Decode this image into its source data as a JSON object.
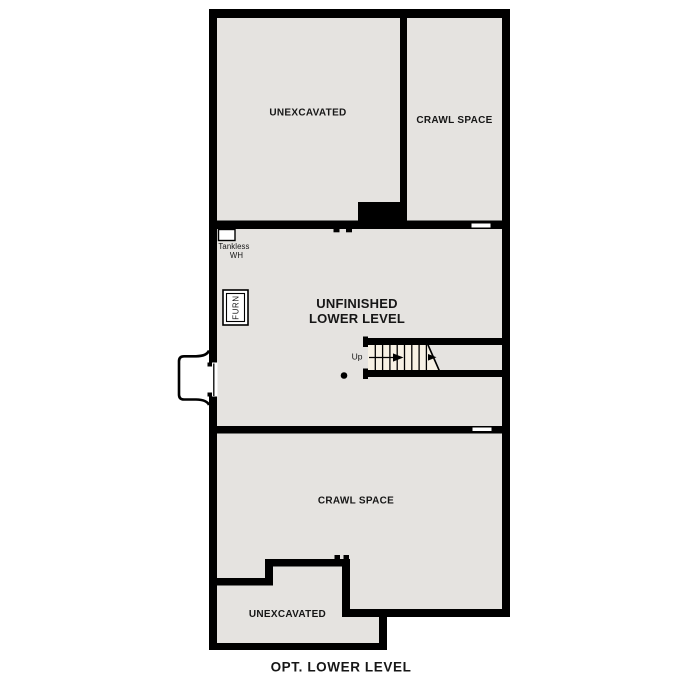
{
  "plan": {
    "title": "OPT. LOWER LEVEL"
  },
  "rooms": {
    "unexcavated_top": {
      "label": "UNEXCAVATED"
    },
    "crawl_space_top": {
      "label": "CRAWL SPACE"
    },
    "unfinished_lower_level": {
      "label_line1": "UNFINISHED",
      "label_line2": "LOWER LEVEL"
    },
    "crawl_space_bottom": {
      "label": "CRAWL SPACE"
    },
    "unexcavated_bottom": {
      "label": "UNEXCAVATED"
    }
  },
  "fixtures": {
    "tankless_water_heater": {
      "label_line1": "Tankless",
      "label_line2": "WH"
    },
    "furnace": {
      "label": "FURN"
    },
    "stairs": {
      "direction_label": "Up"
    },
    "support_post": {
      "shape": "filled-dot"
    },
    "window_well": {
      "shape": "rounded-bump-out"
    }
  },
  "colors": {
    "background": "#ffffff",
    "wall": "#000000",
    "room_fill": "#e5e3e0",
    "stair_fill": "#f7f1e4",
    "text": "#161616"
  }
}
